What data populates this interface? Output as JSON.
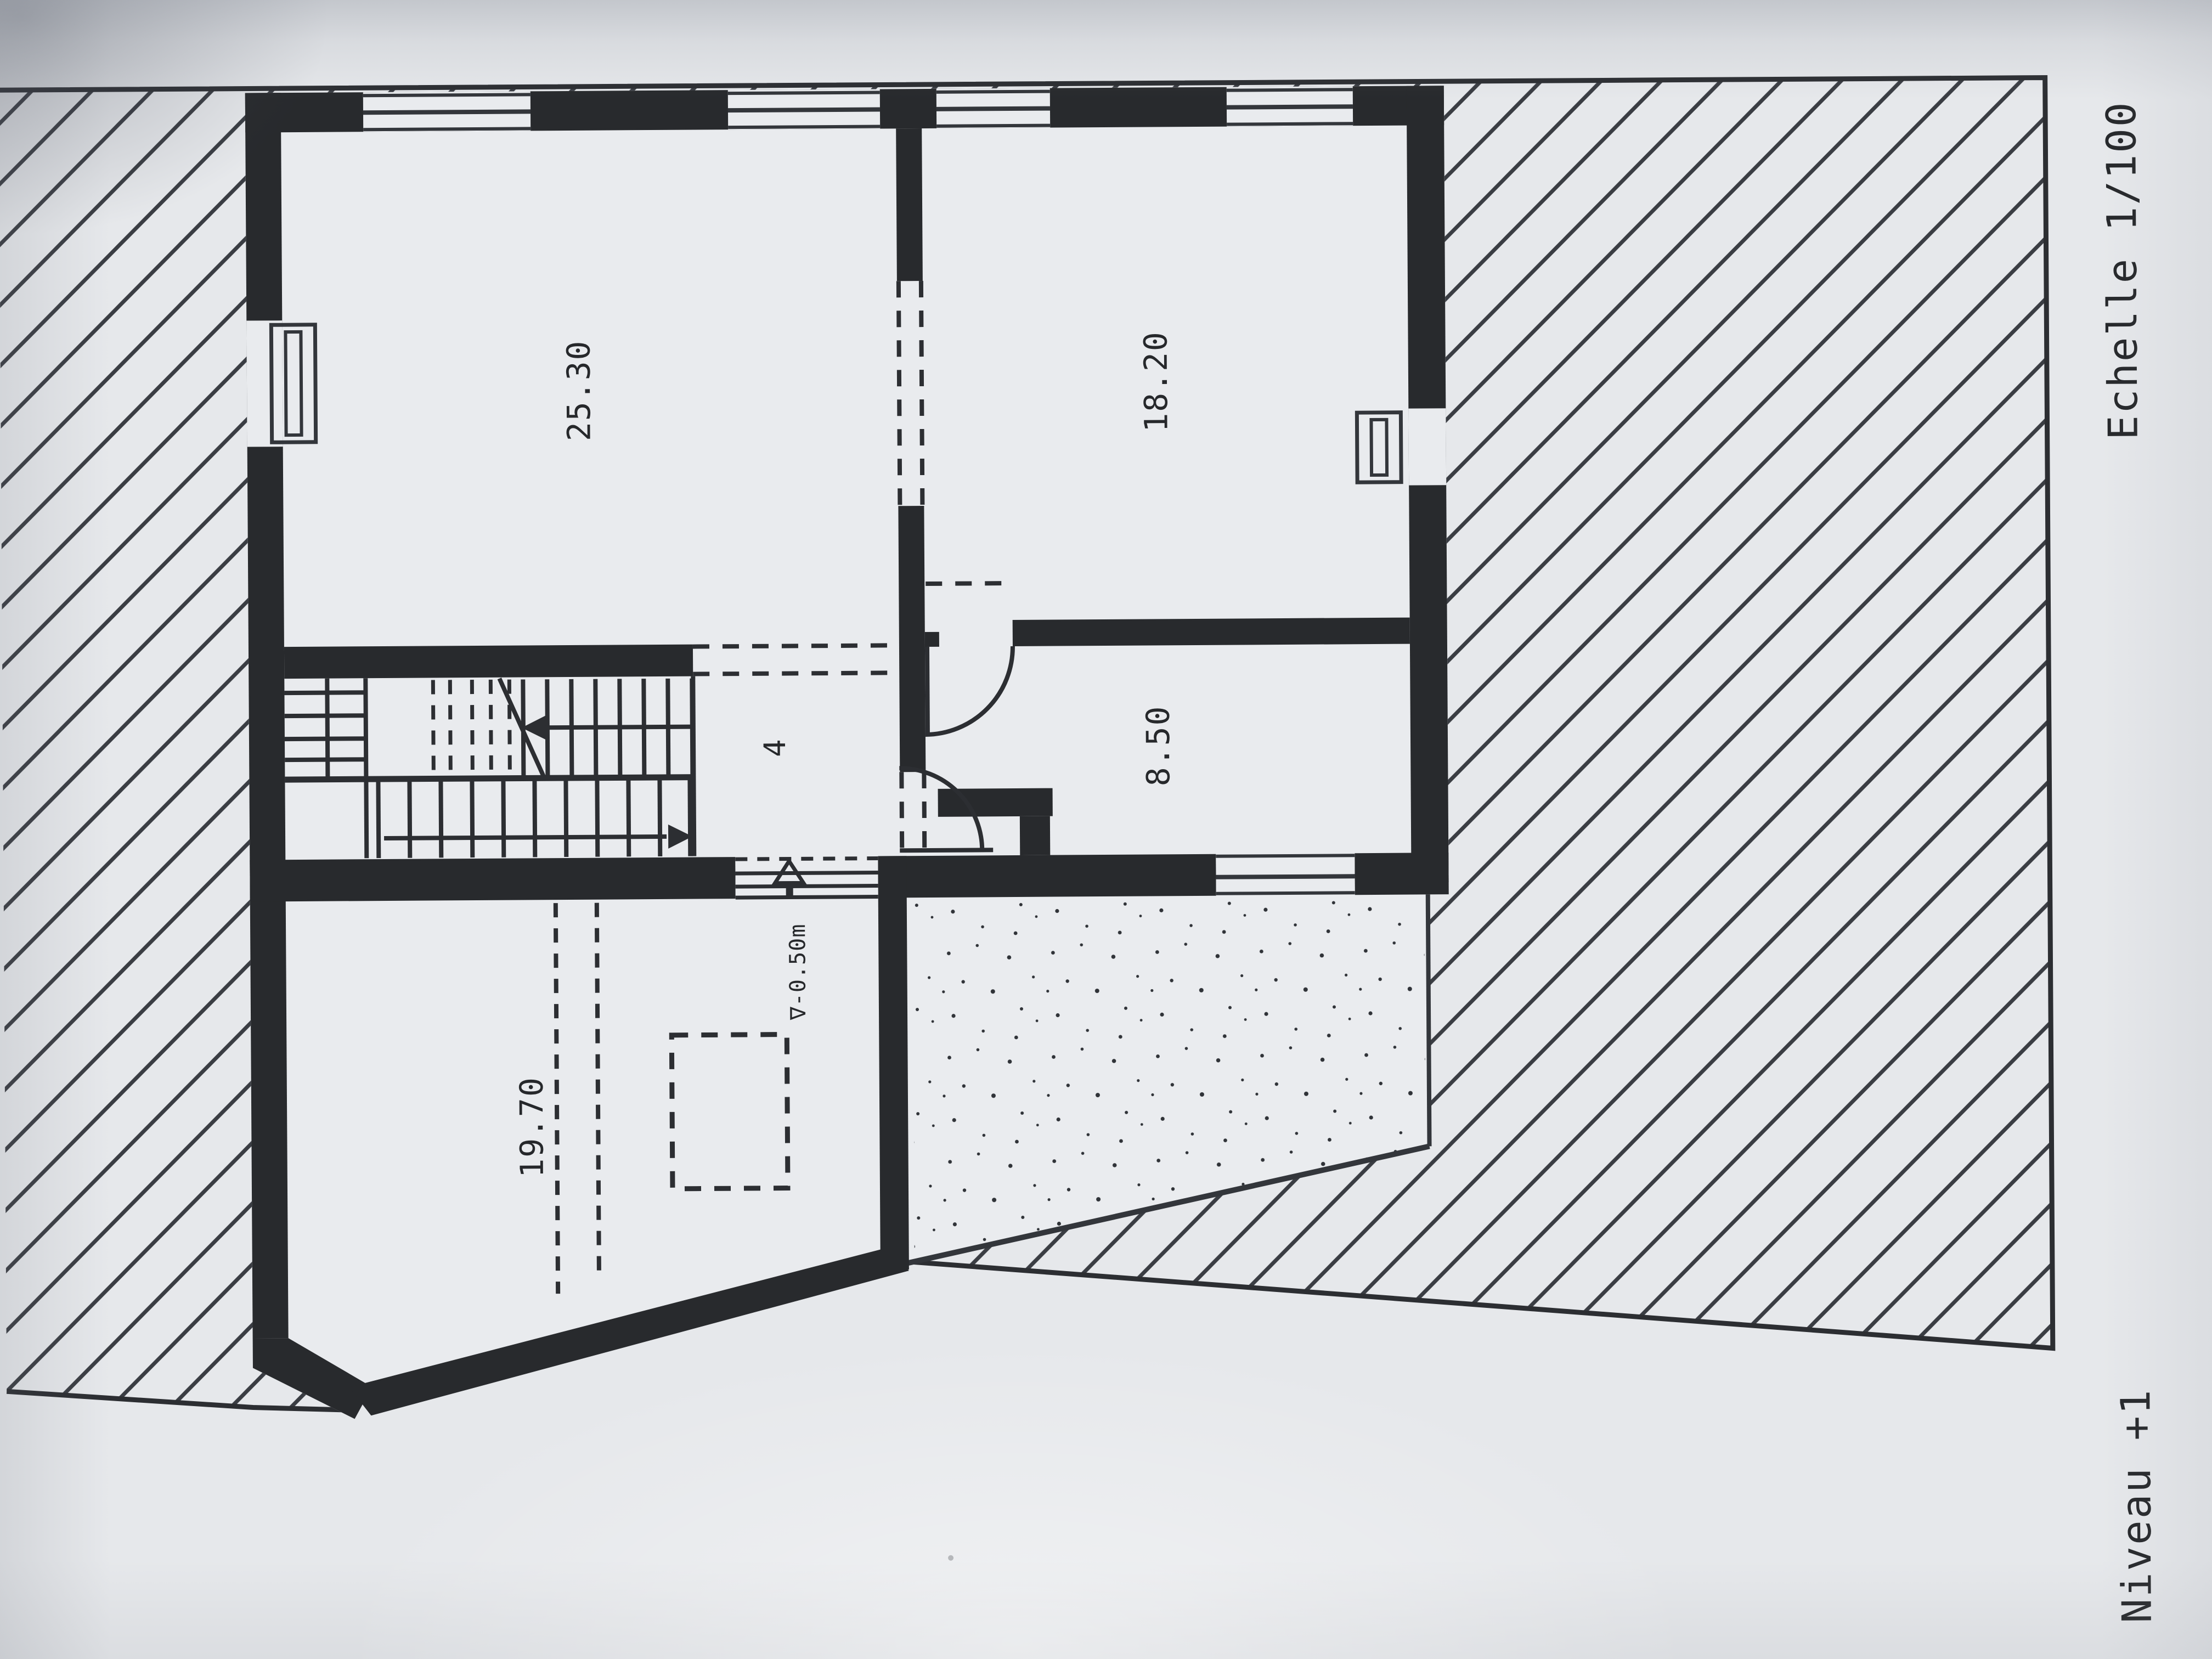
{
  "document": {
    "level_title": "Niveau +1",
    "scale_label": "Echelle 1/100"
  },
  "rooms": [
    {
      "name": "room-top-left",
      "area_label": "25.30"
    },
    {
      "name": "room-top-right",
      "area_label": "18.20"
    },
    {
      "name": "room-middle-right",
      "area_label": "8.50"
    },
    {
      "name": "room-bottom-left",
      "area_label": "19.70"
    },
    {
      "name": "hall",
      "number_label": "4"
    }
  ],
  "annotations": {
    "entry_level_label": "∇-0.50m"
  },
  "symbols": [
    "window-icon",
    "door-arc-icon",
    "stair-up-arrow-icon",
    "stair-down-arrow-icon",
    "entry-step-arrow-icon",
    "chimney-dashed-box",
    "terrace-stipple",
    "site-hatch"
  ],
  "colors": {
    "paper": "#e6e8eb",
    "ink": "#26282b",
    "wall": "#282a2d",
    "hatch_line": "#3a3d43"
  }
}
